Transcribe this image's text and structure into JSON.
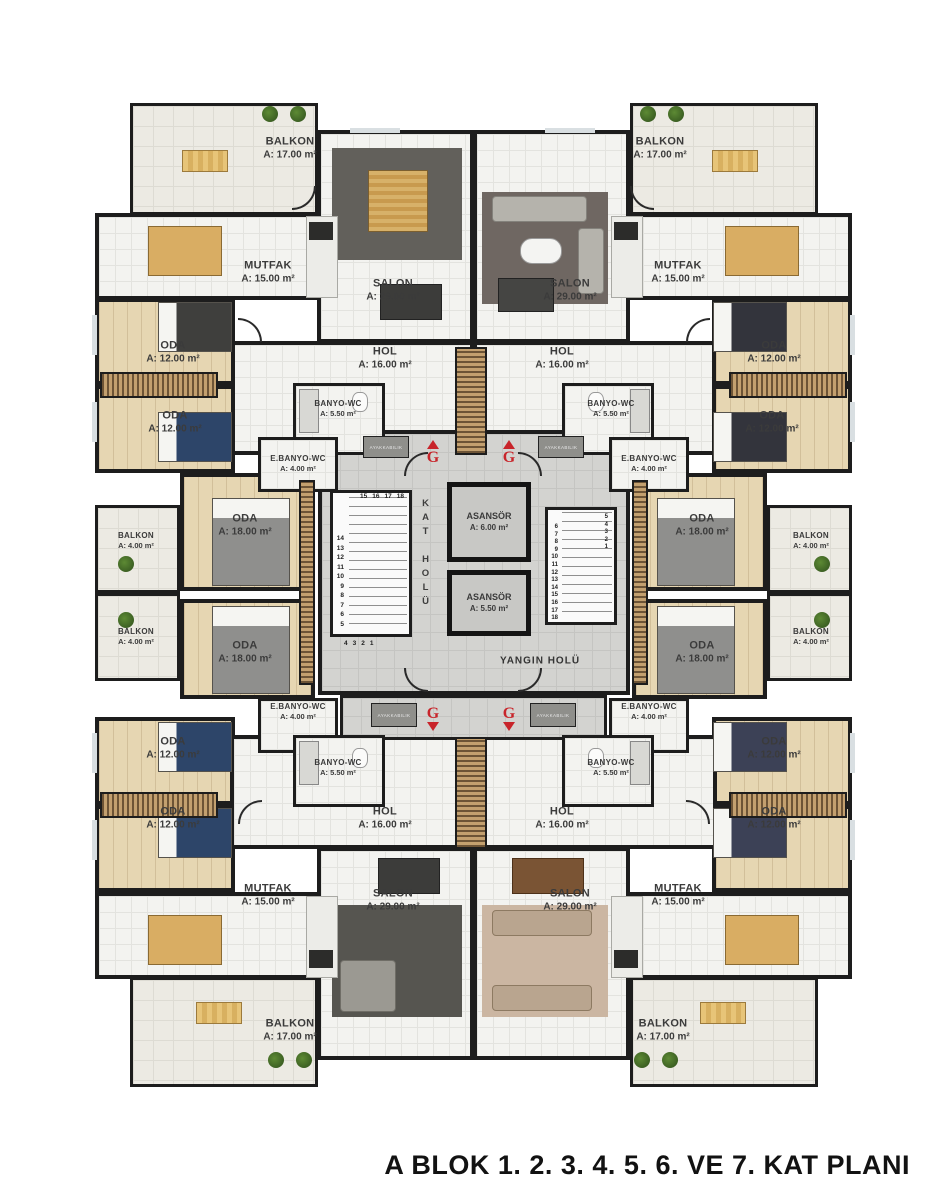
{
  "caption": "A BLOK 1. 2. 3. 4. 5. 6. VE 7. KAT PLANI",
  "room_types": {
    "balkon17": {
      "name": "BALKON",
      "area": "A: 17.00 m²"
    },
    "balkon4": {
      "name": "BALKON",
      "area": "A: 4.00 m²"
    },
    "mutfak": {
      "name": "MUTFAK",
      "area": "A: 15.00 m²"
    },
    "salon": {
      "name": "SALON",
      "area": "A: 29.00 m²"
    },
    "hol": {
      "name": "HOL",
      "area": "A: 16.00 m²"
    },
    "banyo": {
      "name": "BANYO-WC",
      "area": "A: 5.50 m²"
    },
    "ebanyo": {
      "name": "E.BANYO-WC",
      "area": "A: 4.00 m²"
    },
    "oda12": {
      "name": "ODA",
      "area": "A: 12.00 m²"
    },
    "oda18": {
      "name": "ODA",
      "area": "A: 18.00 m²"
    },
    "asansor_buyuk": {
      "name": "ASANSÖR",
      "area": "A: 6.00 m²"
    },
    "asansor_kucuk": {
      "name": "ASANSÖR",
      "area": "A: 5.50 m²"
    }
  },
  "core": {
    "kat_holu": "KAT HOLÜ",
    "yangin_holu": "YANGIN HOLÜ",
    "ayakkabilik": "AYAKKABILIK",
    "g_label": "G"
  },
  "stairs": {
    "left_flight_down": [
      "14",
      "13",
      "12",
      "11",
      "10",
      "9",
      "8",
      "7",
      "6",
      "5"
    ],
    "left_flight_top": [
      "15",
      "16",
      "17",
      "18"
    ],
    "left_flight_bottom": [
      "4",
      "3",
      "2",
      "1"
    ],
    "right_flight_main": [
      "6",
      "7",
      "8",
      "9",
      "10",
      "11",
      "12",
      "13",
      "14",
      "15",
      "16",
      "17",
      "18"
    ],
    "right_flight_start": [
      "5",
      "4",
      "3",
      "2",
      "1"
    ]
  },
  "colors": {
    "wall": "#1d1d1d",
    "wood_floor": "#e6d6b2",
    "tile_floor": "#f3f3f0",
    "balcony_floor": "#eceae3",
    "core_floor": "#d3d3d0",
    "closet_dark": "#6d5436",
    "closet_light": "#c3a06f",
    "stair_red": "#c8242a"
  }
}
